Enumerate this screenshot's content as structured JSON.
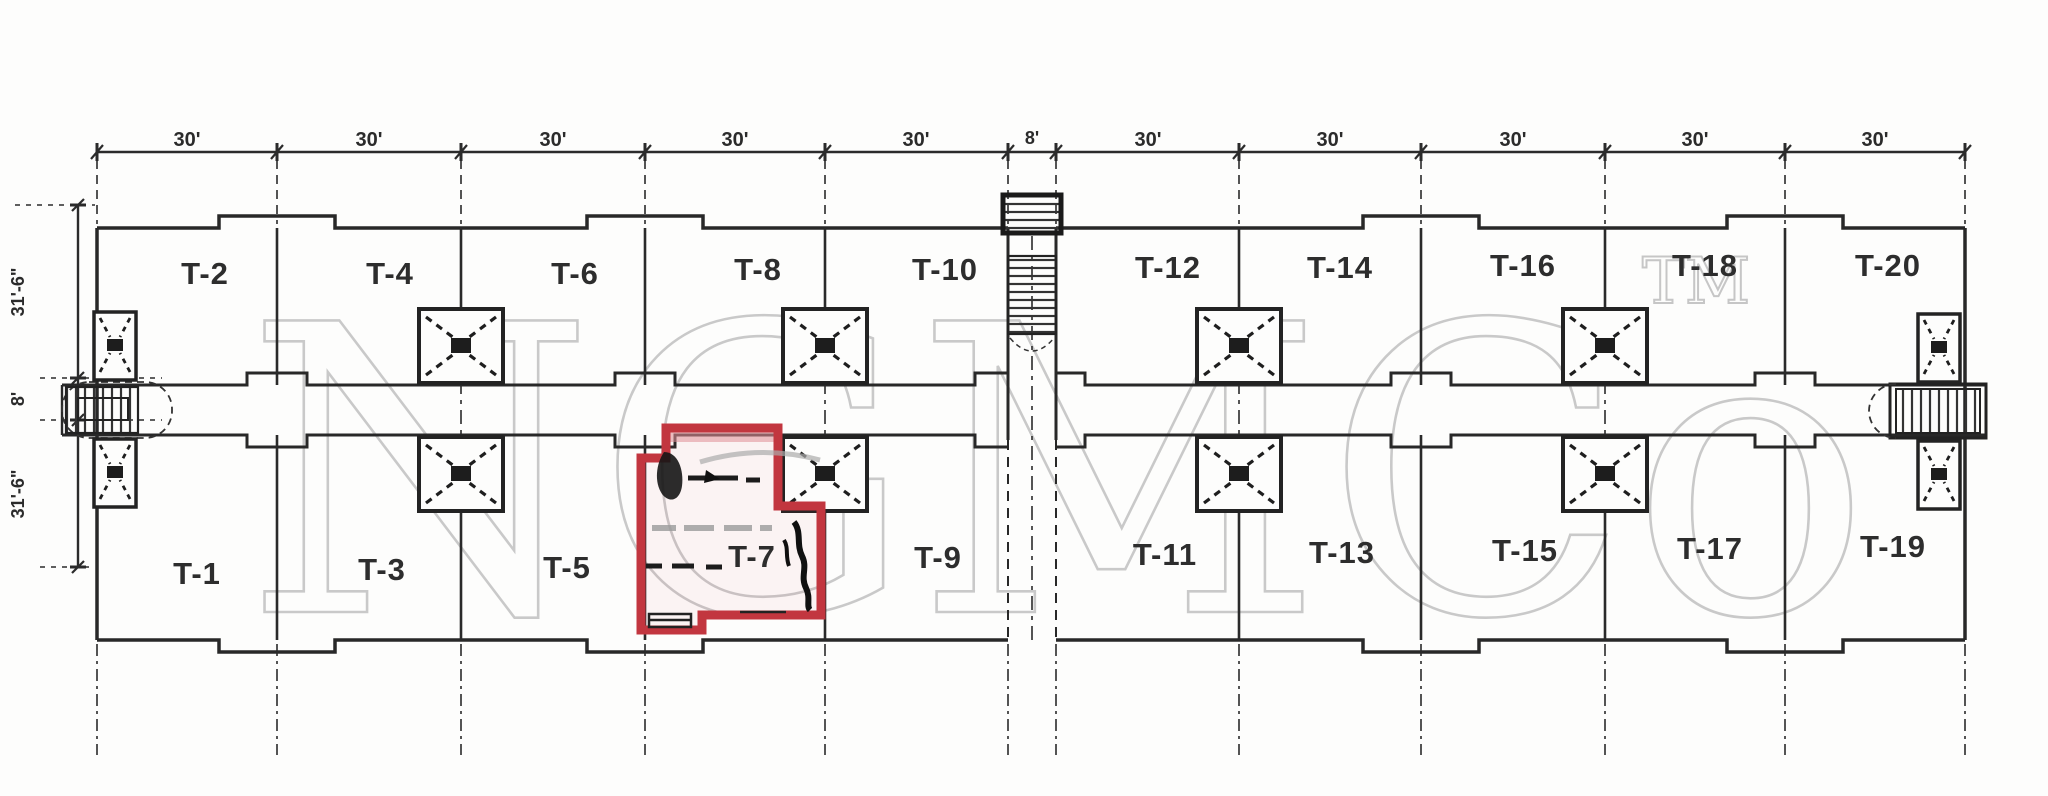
{
  "dimensions": {
    "top": [
      "30'",
      "30'",
      "30'",
      "30'",
      "30'",
      "8'",
      "30'",
      "30'",
      "30'",
      "30'",
      "30'"
    ],
    "left": [
      "31'-6\"",
      "8'",
      "31'-6\""
    ]
  },
  "units": {
    "top_row": [
      "T-2",
      "T-4",
      "T-6",
      "T-8",
      "T-10",
      "T-12",
      "T-14",
      "T-16",
      "T-18",
      "T-20"
    ],
    "bottom_row": [
      "T-1",
      "T-3",
      "T-5",
      "T-7",
      "T-9",
      "T-11",
      "T-13",
      "T-15",
      "T-17",
      "T-19"
    ]
  },
  "highlight": {
    "unit": "T-7",
    "color": "#c2363f"
  },
  "watermark": {
    "text": "NGMCo",
    "tm": "TM",
    "color": "#c9c9c9"
  },
  "colors": {
    "ink": "#2a2a2a",
    "paper": "#fdfdfc",
    "highlight_red": "#c2363f",
    "watermark_gray": "#c9c9c9"
  }
}
